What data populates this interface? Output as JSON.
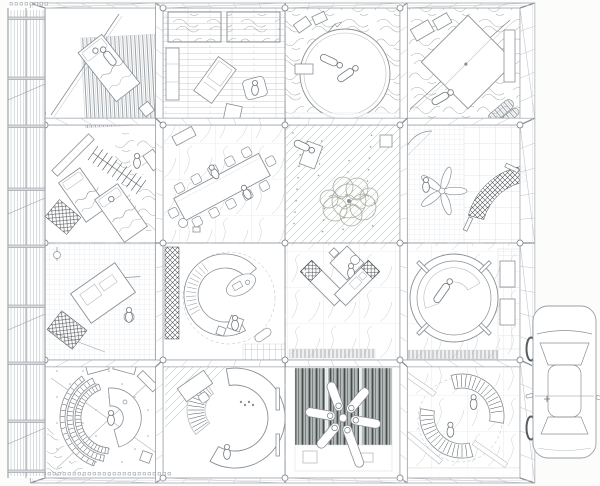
{
  "meta": {
    "title": "One-point perspective plan drawing: sixteen furnished rooms behind a louvred facade, with a parked car at right",
    "canvas_w": 600,
    "canvas_h": 486
  },
  "palette": {
    "background": "#fcfcfb",
    "line": "#8a9096",
    "line_light": "#b7bcc1",
    "line_faint": "#d8dbdd",
    "line_dark": "#4c5256",
    "scribble": "#a6ae9f",
    "wall_fill": "#ffffff",
    "rug_dark": "#b4bab8"
  },
  "grid": {
    "col_edges": [
      45,
      163,
      285,
      400,
      520
    ],
    "row_edges": [
      8,
      125,
      243,
      360,
      478
    ],
    "projection_center": [
      282,
      243
    ],
    "extrusion_kx": 0.062,
    "extrusion_ky": 0.058
  },
  "rooms": [
    {
      "id": "r1c1",
      "row": 0,
      "col": 0,
      "type": "bedroom-single",
      "floor": "plain",
      "desc": "single bed set diagonally on a fine-striped rug"
    },
    {
      "id": "r1c2",
      "row": 0,
      "col": 1,
      "type": "lounge",
      "floor": "plank",
      "desc": "lounge with recliner, armchair and side table; two textured skylights"
    },
    {
      "id": "r1c3",
      "row": 0,
      "col": 2,
      "type": "round-bed",
      "floor": "scribble",
      "desc": "large round bed with two reclining figures and a small flag"
    },
    {
      "id": "r1c4",
      "row": 0,
      "col": 3,
      "type": "diagonal-bed",
      "floor": "scribble",
      "desc": "large square bed rotated 45 degrees with reclining figure and rolled blanket"
    },
    {
      "id": "r2c1",
      "row": 1,
      "col": 0,
      "type": "twin-bedroom",
      "floor": "plain",
      "desc": "twin beds, hanging clothes rail and dark stair panel"
    },
    {
      "id": "r2c2",
      "row": 1,
      "col": 1,
      "type": "dining-room",
      "floor": "vein",
      "desc": "long dining table with ten chairs and two seated figures on veined stone floor"
    },
    {
      "id": "r2c3",
      "row": 1,
      "col": 2,
      "type": "garden",
      "floor": "diag",
      "desc": "indoor garden with scribbled tree, gravel dots and reclining figure"
    },
    {
      "id": "r2c4",
      "row": 1,
      "col": 3,
      "type": "hammock-room",
      "floor": "grid-small",
      "desc": "ceiling fan seat and dark woven hammock over tiled floor"
    },
    {
      "id": "r3c1",
      "row": 2,
      "col": 0,
      "type": "drafting-room",
      "floor": "grid-small",
      "desc": "drafting workstation with seated figure on gridded floor, hatched ramp"
    },
    {
      "id": "r3c2",
      "row": 2,
      "col": 1,
      "type": "curved-sofa",
      "floor": "plain",
      "desc": "crescent sofa-desk with curved shelf, oval rug, pouf and seated figure"
    },
    {
      "id": "r3c3",
      "row": 2,
      "col": 2,
      "type": "kitchen",
      "floor": "vein",
      "desc": "V-shaped kitchen counter with stove, sink, fridge and small square table"
    },
    {
      "id": "r3c4",
      "row": 2,
      "col": 3,
      "type": "bathtub",
      "floor": "vein",
      "desc": "circular bathtub with reclining figure; tiled service wall with two doors"
    },
    {
      "id": "r4c1",
      "row": 3,
      "col": 0,
      "type": "library-arc",
      "floor": "dots",
      "desc": "circular desk ringed by arc bookshelves with seated figure"
    },
    {
      "id": "r4c2",
      "row": 3,
      "col": 1,
      "type": "curved-wall",
      "floor": "plain",
      "desc": "C-shaped curved wall with stepped shelf, corner desk and standing figure"
    },
    {
      "id": "r4c3",
      "row": 3,
      "col": 2,
      "type": "futon-star",
      "floor": "plain",
      "desc": "six sleepers radiating star-wise on a dark striped mat"
    },
    {
      "id": "r4c4",
      "row": 3,
      "col": 3,
      "type": "reading-arcs",
      "floor": "vein",
      "desc": "two facing arc bookshelf desks with seated figures"
    }
  ],
  "facade": {
    "x": 8,
    "width": 37,
    "slab_ys": [
      17,
      77,
      125,
      188,
      245,
      305,
      362,
      420,
      470
    ],
    "diag_ys": [
      100,
      214,
      330,
      444
    ]
  },
  "ticks": {
    "rows": [
      {
        "x0": 10,
        "x1": 46,
        "y": 2.5
      },
      {
        "x0": 8,
        "x1": 46,
        "y": 112
      },
      {
        "x0": 8,
        "x1": 168,
        "y": 472.5
      }
    ],
    "step": 5,
    "size": 2.5
  },
  "car": {
    "x": 531,
    "y": 306,
    "width": 65,
    "height": 152,
    "orientation": "front-up",
    "wheels_side": "left"
  }
}
